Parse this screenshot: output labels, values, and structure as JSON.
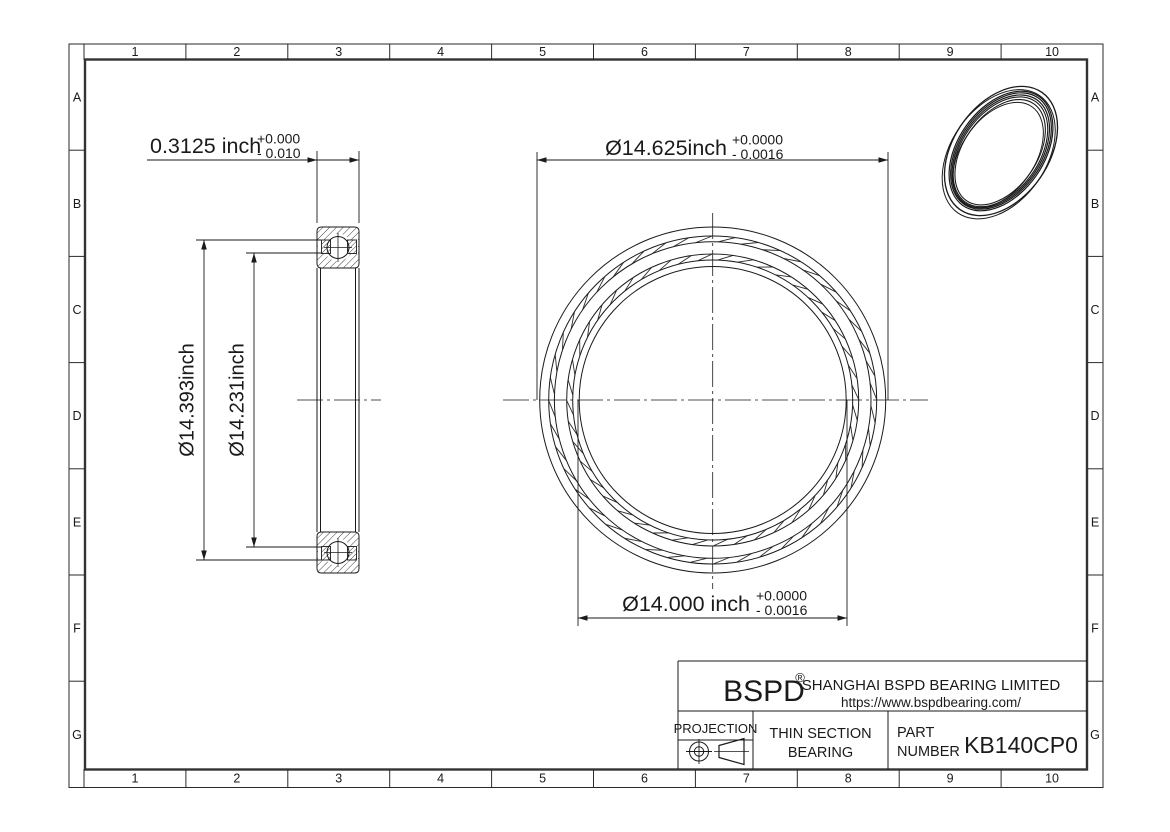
{
  "page": {
    "background": "#ffffff",
    "line_color": "#1a1a1a"
  },
  "grid": {
    "columns": [
      "1",
      "2",
      "3",
      "4",
      "5",
      "6",
      "7",
      "8",
      "9",
      "10"
    ],
    "rows": [
      "A",
      "B",
      "C",
      "D",
      "E",
      "F",
      "G"
    ]
  },
  "dims": {
    "width": {
      "value": "0.3125 inch",
      "tol_plus": "+0.000",
      "tol_minus": "- 0.010"
    },
    "outer_dia": {
      "value": "Ø14.625inch",
      "tol_plus": "+0.0000",
      "tol_minus": "- 0.0016"
    },
    "bore_dia": {
      "value": "Ø14.000 inch",
      "tol_plus": "+0.0000",
      "tol_minus": "- 0.0016"
    },
    "outer_land_dia": {
      "value": "Ø14.393inch"
    },
    "inner_land_dia": {
      "value": "Ø14.231inch"
    }
  },
  "title_block": {
    "logo": "BSPD",
    "registered_mark": "®",
    "company_name": "SHANGHAI BSPD BEARING LIMITED",
    "website": "https://www.bspdbearing.com/",
    "projection_label": "PROJECTION",
    "product_type_line1": "THIN SECTION",
    "product_type_line2": "BEARING",
    "part_number_label_line1": "PART",
    "part_number_label_line2": "NUMBER",
    "part_number": "KB140CP0"
  }
}
